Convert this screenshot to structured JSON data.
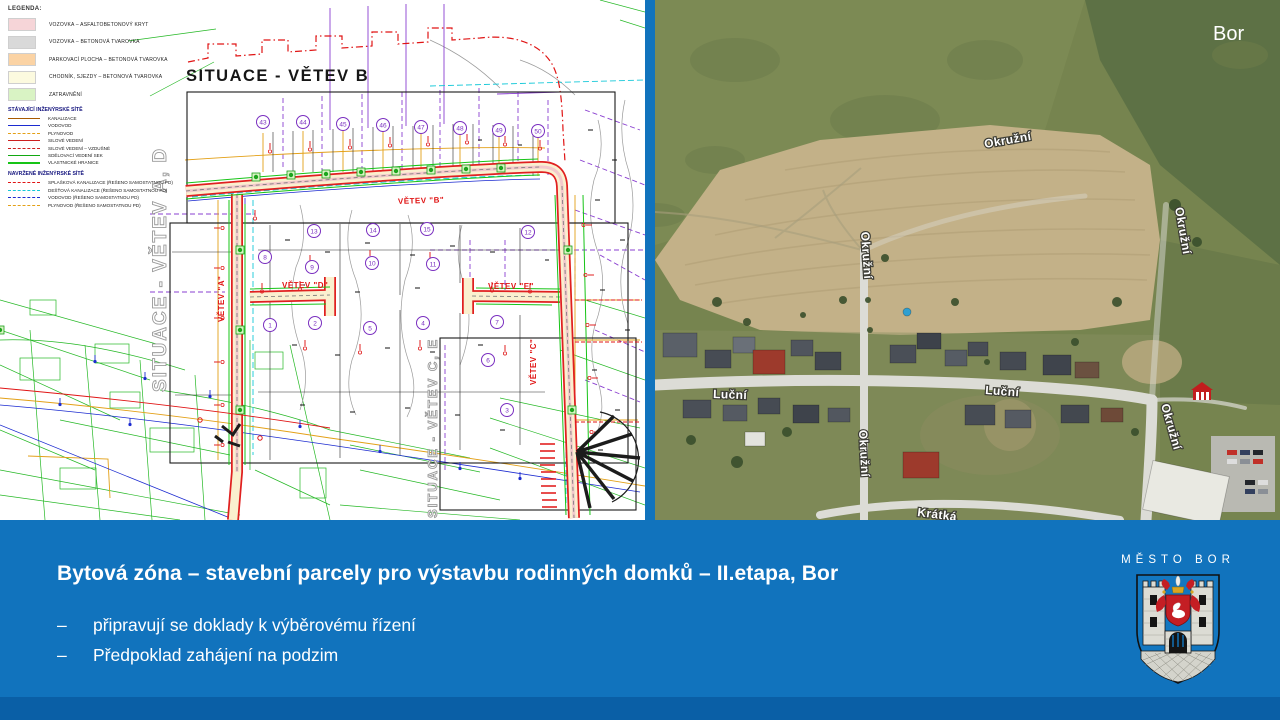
{
  "slide": {
    "bg_color": "#1173BD",
    "footer_strip_color": "#0A5FA6"
  },
  "map": {
    "title": "SITUACE - VĚTEV B",
    "side_left": "SITUACE - VĚTEV A, D",
    "side_right": "SITUACE - VĚTEV C, E",
    "branches": [
      "VĚTEV \"B\"",
      "VĚTEV \"A\"",
      "VĚTEV \"C\"",
      "VĚTEV \"D\"",
      "VĚTEV \"E\""
    ],
    "parcels_top": [
      "43",
      "44",
      "45",
      "46",
      "47",
      "48",
      "49",
      "50"
    ],
    "parcels": [
      "13",
      "14",
      "15",
      "12",
      "8",
      "9",
      "10",
      "11",
      "1",
      "2",
      "5",
      "4",
      "7",
      "6",
      "3"
    ]
  },
  "legend": {
    "heading": "LEGENDA:",
    "surfaces": [
      {
        "label": "VOZOVKA – ASFALTOBETONOVÝ KRYT",
        "color": "#f6d5d8"
      },
      {
        "label": "VOZOVKA – BETONOVÁ TVAROVKA",
        "color": "#d9d9d9"
      },
      {
        "label": "PARKOVACÍ PLOCHA – BETONOVÁ TVAROVKA",
        "color": "#fbd3a4"
      },
      {
        "label": "CHODNÍK, SJEZDY – BETONOVÁ TVAROVKA",
        "color": "#fcfadf"
      },
      {
        "label": "ZATRAVNĚNÍ",
        "color": "#d9f3c4"
      }
    ],
    "existing_heading": "STÁVAJÍCÍ INŽENÝRSKÉ SÍTĚ",
    "existing": [
      {
        "label": "KANALIZACE",
        "color": "#a85a00"
      },
      {
        "label": "VODOVOD",
        "color": "#1c2bd0"
      },
      {
        "label": "PLYNOVOD",
        "color": "#e3a017"
      },
      {
        "label": "SILOVÉ VEDENÍ",
        "color": "#cc2020"
      },
      {
        "label": "SILOVÉ VEDENÍ – VZDUŠNÉ",
        "color": "#cc2020"
      },
      {
        "label": "SDĚLOVACÍ VEDENÍ SEK",
        "color": "#12a812"
      },
      {
        "label": "VLASTNICKÉ HRANICE",
        "color": "#17c417"
      }
    ],
    "proposed_heading": "NAVRŽENÉ INŽENÝRSKÉ SÍTĚ",
    "proposed": [
      {
        "label": "SPLAŠKOVÁ KANALIZACE (ŘEŠENO SAMOSTATNOU PD)",
        "color": "#e01414"
      },
      {
        "label": "DEŠŤOVÁ KANALIZACE (ŘEŠENO SAMOSTATNOU PD)",
        "color": "#15c8d8"
      },
      {
        "label": "VODOVOD (ŘEŠENO SAMOSTATNOU PD)",
        "color": "#1c2bd0"
      },
      {
        "label": "PLYNOVOD (ŘEŠENO SAMOSTATNOU PD)",
        "color": "#e3a017"
      }
    ]
  },
  "photo": {
    "corner_label": "Bor",
    "streets": [
      "Okružní",
      "Okružní",
      "Okružní",
      "Luční",
      "Luční",
      "Okružní",
      "Okružní",
      "Krátká"
    ]
  },
  "footer": {
    "title": "Bytová zóna – stavební parcely pro výstavbu rodinných domků – II.etapa, Bor",
    "marker": "–",
    "bullets": [
      "připravují se doklady k výběrovému řízení",
      "Předpoklad zahájení na podzim"
    ],
    "city_label": "MĚSTO BOR"
  }
}
